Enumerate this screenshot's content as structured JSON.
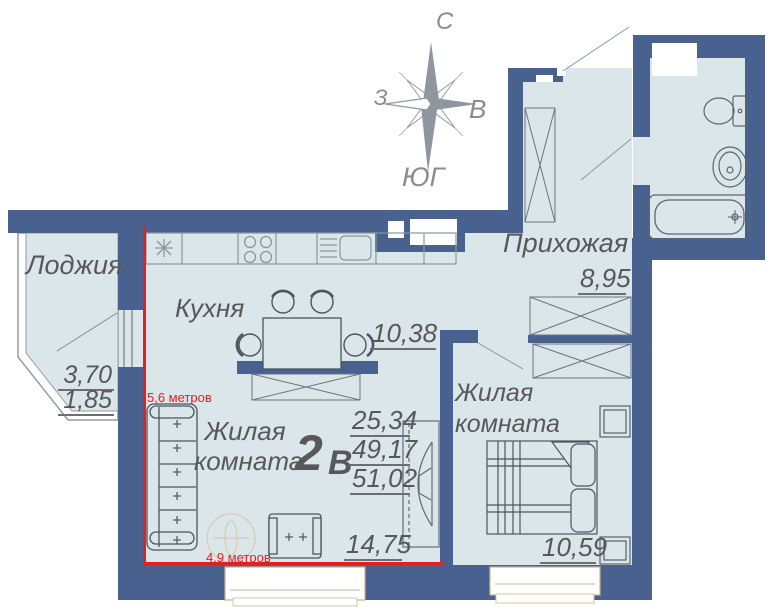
{
  "title": "Apartment floor plan 2В",
  "compass": {
    "north": "С",
    "east": "В",
    "south": "ЮГ",
    "west": "З"
  },
  "rooms": {
    "loggia": {
      "label": "Лоджия",
      "area_full": "3,70",
      "area_half": "1,85"
    },
    "kitchen": {
      "label": "Кухня",
      "area": "10,38"
    },
    "hallway": {
      "label": "Прихожая",
      "area": "8,95"
    },
    "living": {
      "label": "Жилая комната",
      "area": "14,75"
    },
    "bedroom": {
      "label": "Жилая комната",
      "area": "10,59"
    }
  },
  "summary": {
    "type_number": "2",
    "type_letter": "В",
    "living_area": "25,34",
    "area_without_loggia": "49,17",
    "total_area": "51,02"
  },
  "measurements": {
    "vertical_label": "5,6 метров",
    "horizontal_label": "4,9 метров"
  },
  "kitchen_symbol": "*",
  "colors": {
    "wall": "#48618f",
    "floor": "#dbe6ea",
    "accent_red": "#e31f1f",
    "label_text": "#58585a",
    "compass_gray": "#8f969e",
    "window_frame": "#c9b391",
    "furniture_stroke": "#5a6572"
  }
}
